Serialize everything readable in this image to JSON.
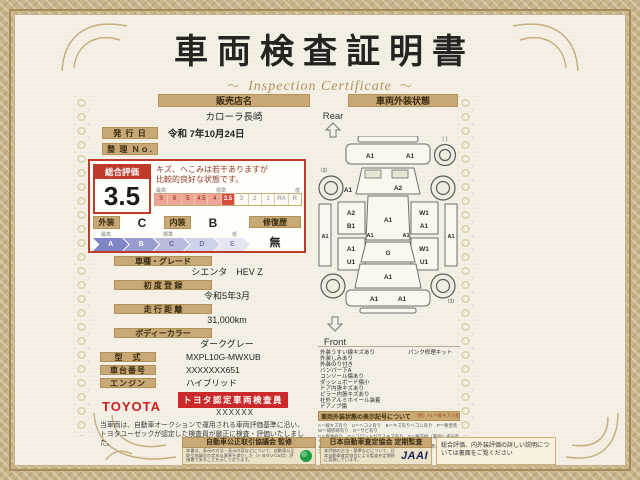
{
  "title": {
    "main": "車両検査証明書",
    "sub": "Inspection Certificate",
    "deco": "～"
  },
  "seller": {
    "label": "販売店名",
    "value": "カローラ長崎"
  },
  "issue_date": {
    "label": "発 行 日",
    "value": "令和 7年10月24日"
  },
  "ref_no": {
    "label": "整 理 Ｎｏ.",
    "value": ""
  },
  "rating": {
    "label": "総合評価",
    "score": "3.5",
    "comment_line1": "キズ、へこみは若干ありますが",
    "comment_line2": "比較的良好な状態です。",
    "scale_high": "最高",
    "scale_mid": "標準",
    "scale_low": "低",
    "scale": [
      "S",
      "6",
      "5",
      "4.5",
      "4",
      "3.5",
      "3",
      "2",
      "1",
      "RA",
      "R"
    ],
    "exterior_label": "外装",
    "exterior_grade": "C",
    "interior_label": "内装",
    "interior_grade": "B",
    "repair_label": "修復歴",
    "repair_value": "無",
    "grades": [
      "A",
      "B",
      "C",
      "D",
      "E"
    ]
  },
  "fields": {
    "model": {
      "label": "車種・グレード",
      "value": "シエンタ　HEV Z"
    },
    "first_reg": {
      "label": "初 度 登 録",
      "value": "令和5年3月"
    },
    "mileage": {
      "label": "走 行 距 離",
      "value": "31,000km"
    },
    "color": {
      "label": "ボディーカラー",
      "value": "ダークグレー"
    },
    "model_code": {
      "label": "型　式",
      "value": "MXPL10G-MWXUB"
    },
    "chassis_no": {
      "label": "車台番号",
      "value": "XXXXXXX651"
    },
    "engine": {
      "label": "エンジン",
      "value": "ハイブリッド"
    }
  },
  "inspector": {
    "brand": "TOYOTA",
    "badge": "トヨタ認定車両検査員",
    "id": "XXXXXX"
  },
  "disclaimer": "当車両は、自動車オークションで運用される車両評価基準に沿い、トヨタユーゼックが認定した検査員が厳正に検査・評価いたしました。",
  "exterior_panel": {
    "header": "車両外装状態",
    "rear_label": "Rear",
    "front_label": "Front",
    "diagram": {
      "spare": "〔 〕",
      "tread_rl": "〔3〕",
      "tread_fr": "〔3〕",
      "zones": {
        "rear_bumper_l": "A1",
        "rear_bumper_r": "A1",
        "rear_gate": "A2",
        "rear_fender_l": "A1",
        "quarter_l_top": "A2",
        "quarter_l_bottom": "B1",
        "door_l_top": "A1",
        "door_l_bottom": "U1",
        "quarter_r_top": "W1",
        "quarter_r_bottom": "A1",
        "door_r_top": "W1",
        "door_r_bottom": "U1",
        "rocker_l": "A1",
        "rocker_r": "A1",
        "side_l": "A1",
        "side_r": "A1",
        "roof": "A1",
        "windshield": "G",
        "hood": "A1",
        "front_bumper_l": "A1",
        "front_bumper_r": "A1"
      }
    },
    "notes": [
      "外装うすい線キズあり",
      "外装しみあり",
      "外装のり付き",
      "バンパー下A",
      "コンソール傷あり",
      "ダッシュボード傷小",
      "ドア内張キズあり",
      "ピラー内張キズあり",
      "社外アルミホイール装着",
      "ドアノブ傷"
    ],
    "notes_right": [
      "パンク修理キット"
    ],
    "legend": {
      "header": "車両外装状態の表示記号について",
      "example": "（例）A1＝線キズ小程度有り",
      "lines": [
        "A＝線キズ有り　U＝ヘコミ有り　B＝キズ有りヘコミ有り　P＝要塗装　W＝補修跡有り　S＝サビ有り",
        "C＝腐食有り　G＝フロントガラスキズ有り　X＝要交換（裏面に表記有り）　XX＝交換跡有り",
        "1＝小程度　2＝中程度　3＝中程度以上　・トヨタ車両基準のキズの大きさを表示しています"
      ]
    }
  },
  "footer": {
    "fair_trade": {
      "header": "自動車公正取引協議会 監修",
      "text": "本書は、表示の方法・表示内容などについて、自動車公正取引協議会の定める基準を満たした（トヨタU-Car用）評価書であることを示しております。"
    },
    "jaai": {
      "header": "日本自動車査定協会 定期監査",
      "text": "本評価の方法・基準などについて、日本自動車査定協会による監査を定期的に実施しています。",
      "logo": "JAAI"
    },
    "note": "総合評価、内外装評価の詳しい説明については裏面をご覧ください"
  }
}
